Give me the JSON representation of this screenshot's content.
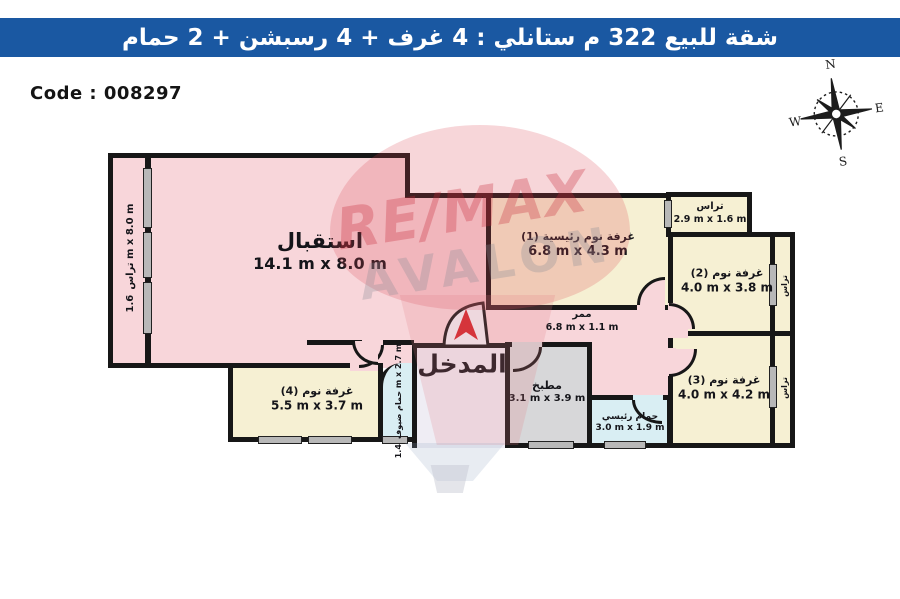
{
  "header": {
    "title": "شقة للبيع 322 م ستانلي :  4 غرف + 4 رسبشن + 2 حمام"
  },
  "code_label": "Code : 008297",
  "compass": {
    "n": "N",
    "e": "E",
    "s": "S",
    "w": "W"
  },
  "watermark": {
    "line1": "RE/MAX",
    "line2": "AVALON"
  },
  "rooms": {
    "reception": {
      "name": "استقبال",
      "dims": "14.1 m x 8.0 m"
    },
    "terrace_left": {
      "name": "تراس",
      "dims": "1.6 m x 8.0 m"
    },
    "master_bedroom": {
      "name": "غرفة نوم رئيسية (1)",
      "dims": "6.8 m x 4.3 m"
    },
    "terrace_top": {
      "name": "تراس",
      "dims": "2.9 m x 1.6 m"
    },
    "bedroom2": {
      "name": "غرفة نوم (2)",
      "dims": "4.0 m x 3.8 m"
    },
    "bedroom3": {
      "name": "غرفة نوم (3)",
      "dims": "4.0 m x 4.2 m"
    },
    "bedroom4": {
      "name": "غرفة نوم (4)",
      "dims": "5.5 m x 3.7 m"
    },
    "corridor": {
      "name": "ممر",
      "dims": "6.8 m x 1.1 m"
    },
    "kitchen": {
      "name": "مطبخ",
      "dims": "3.1 m x 3.9 m"
    },
    "master_bath": {
      "name": "حمام رئيسي",
      "dims": "3.0 m x 1.9 m"
    },
    "guest_bath": {
      "name": "حمام ضيوف",
      "dims": "1.4 m x 2.7 m"
    },
    "terrace_right2": {
      "name": "تراس"
    },
    "terrace_right3": {
      "name": "تراس"
    },
    "entrance": {
      "name": "المدخل"
    }
  },
  "colors": {
    "header_blue": "#1a58a2",
    "wall_black": "#171717",
    "room_pink": "#f8d6da",
    "room_cream": "#f6f0d3",
    "kitchen_gray": "#d7d7d9",
    "bath_blue": "#d9eef3",
    "entrance_fill": "#efedf4",
    "arrow_red": "#d3232a",
    "window_gray": "#b8b8b8",
    "watermark_red": "#c62837",
    "watermark_gray": "#8c8f96"
  }
}
